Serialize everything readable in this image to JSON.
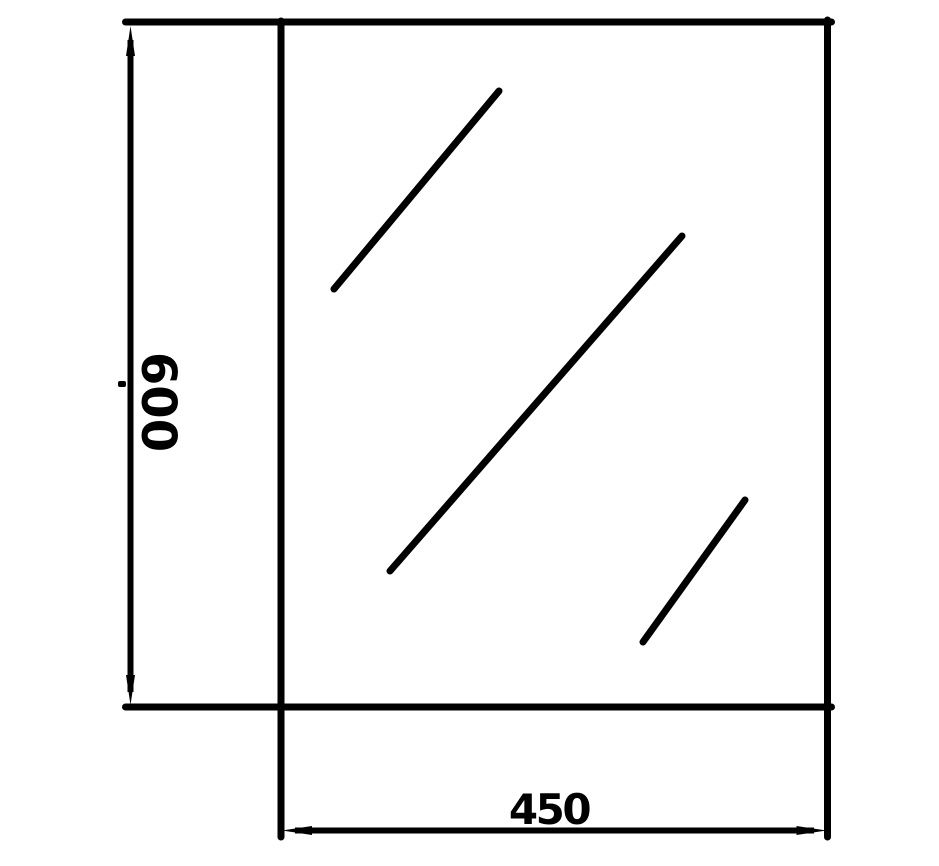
{
  "colors": {
    "background": "#ffffff",
    "line": "#000000"
  },
  "diagram": {
    "type": "technical-dimension-drawing",
    "subject": "mirror-panel",
    "height_dimension": {
      "value": "600",
      "orientation": "vertical"
    },
    "width_dimension": {
      "value": "450",
      "orientation": "horizontal"
    },
    "shine_line_count": 3
  }
}
